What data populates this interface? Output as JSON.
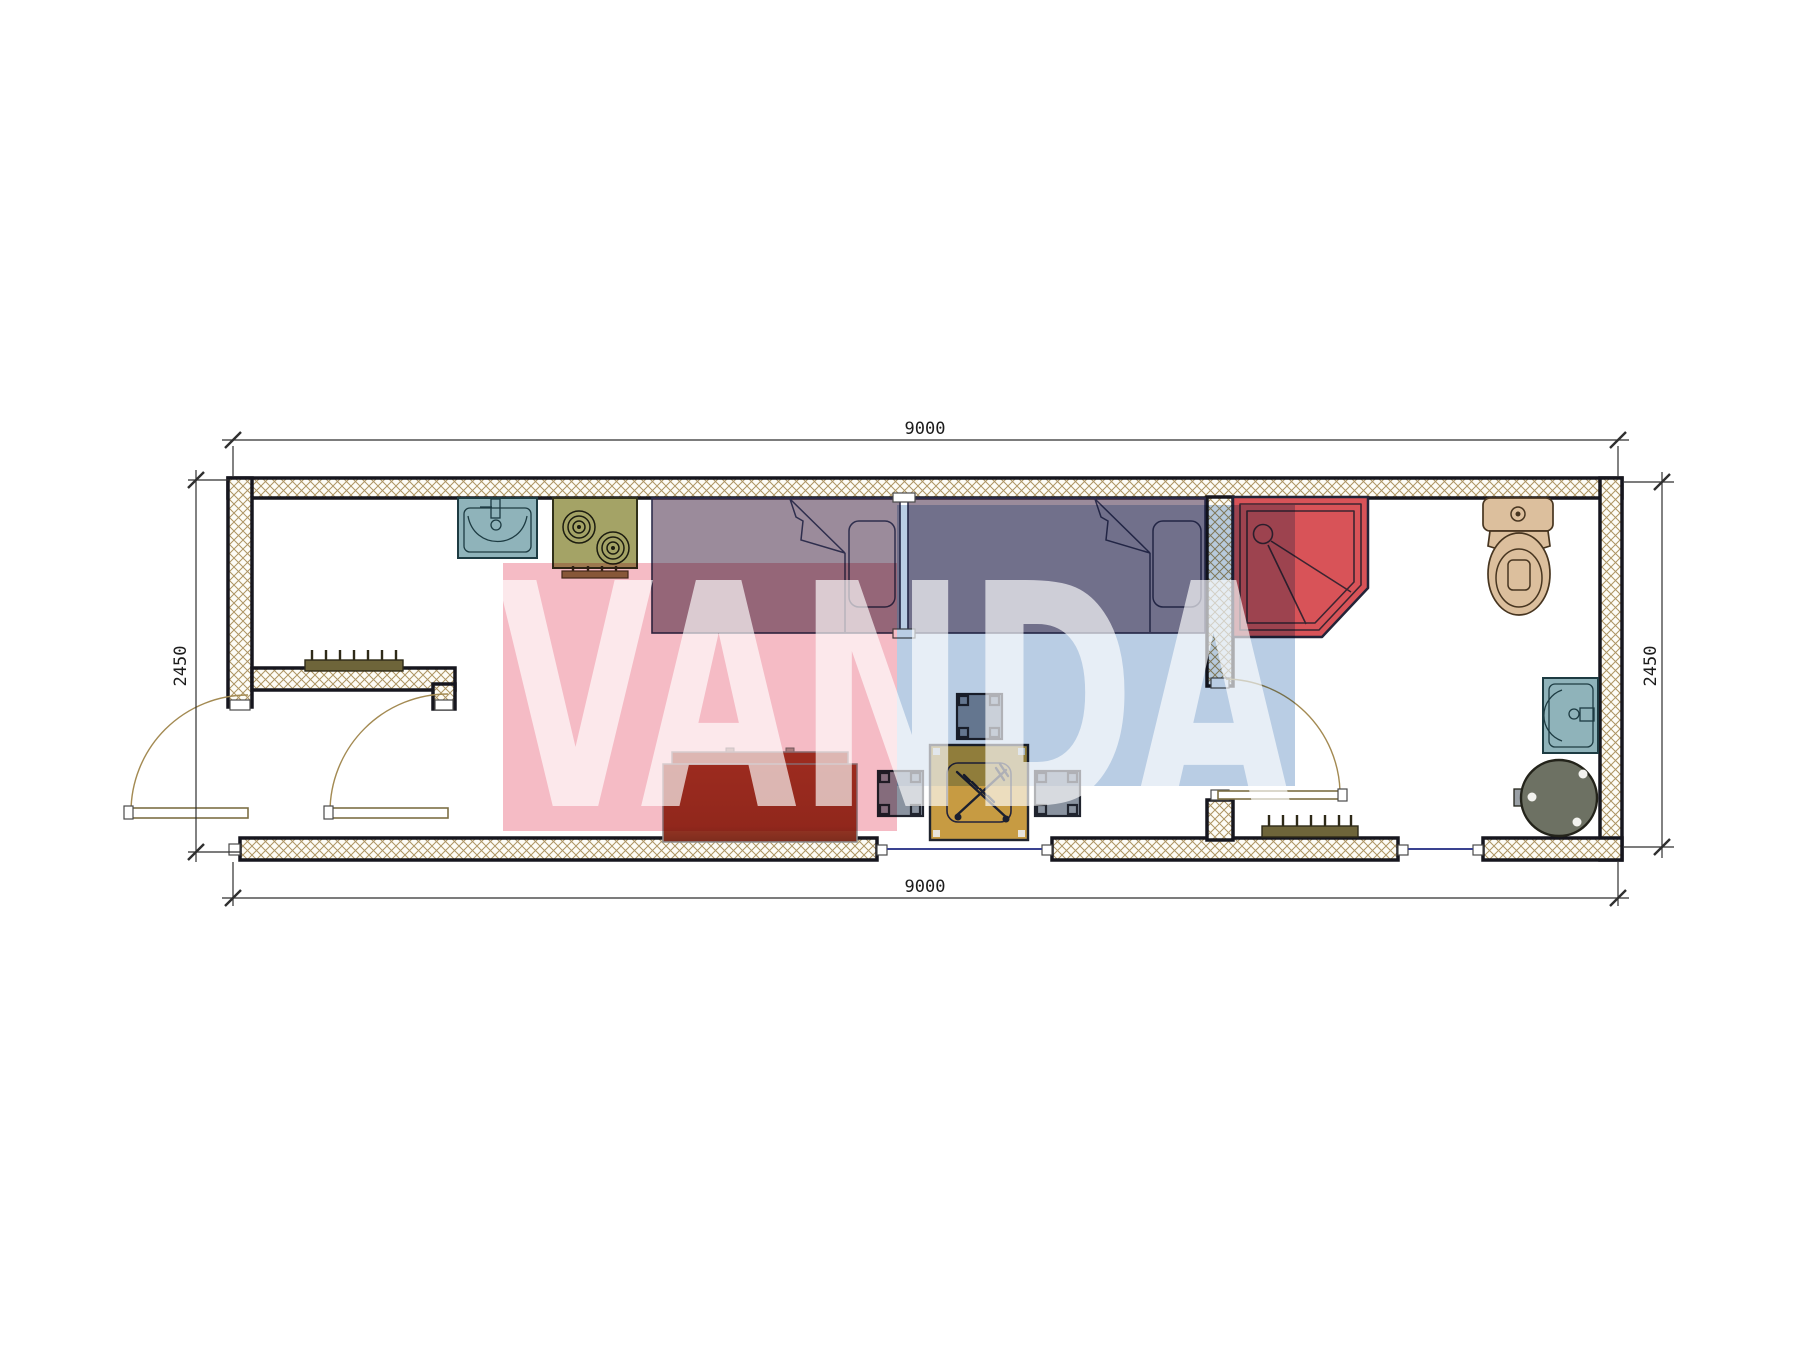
{
  "drawing": {
    "type": "container-house-floor-plan"
  },
  "dimensions": {
    "top": "9000",
    "bottom": "9000",
    "left": "2450",
    "right": "2450"
  },
  "watermark": {
    "text": "VANDA"
  },
  "fixtures": [
    "kitchen-sink",
    "stove",
    "single-bed",
    "single-bed",
    "shower-cabin",
    "toilet",
    "washbasin",
    "water-heater",
    "sofa",
    "dining-table",
    "stool",
    "stool",
    "stool",
    "radiator",
    "radiator",
    "entry-door",
    "vestibule-door",
    "bathroom-door",
    "window",
    "window"
  ],
  "colors": {
    "wall-stroke": "#16161e",
    "hatch-line": "#ad9463",
    "dim-line": "#2f2f2f",
    "dim-text": "#1c1c1c",
    "window-line": "#3a4390",
    "door-arc": "#a38a52",
    "leaf-stroke": "#7d6f45",
    "teal": "#8fb3ba",
    "teal-stroke": "#1d3b42",
    "olive": "#a4a366",
    "olive-stroke": "#30301a",
    "stove-bar": "#8d7748",
    "bed-fill": "rgba(73,44,73,0.55)",
    "bed-stroke": "#2e2e4d",
    "shower-fill": "#d85358",
    "shower-stroke": "#232338",
    "shower-inner": "#3b2531",
    "tan": "#dcbf9d",
    "tan-stroke": "#473520",
    "heater-fill": "#6d7163",
    "heater-stroke": "#23231a",
    "sofa-fill": "#a23a27",
    "sofa-dark": "#8c3220",
    "sofa-stroke": "#8f8f8f",
    "table-fill": "#c79b42",
    "furn-stroke": "#20242e",
    "stool-fill": "#8a93a0",
    "radiator-fill": "#6e653a",
    "radiator-stroke": "#2e2a18",
    "utensil": "#1c2030",
    "pink": "#f5bbc5",
    "blue": "#b9cde4",
    "white-text": "rgba(255,255,255,0.66)"
  }
}
